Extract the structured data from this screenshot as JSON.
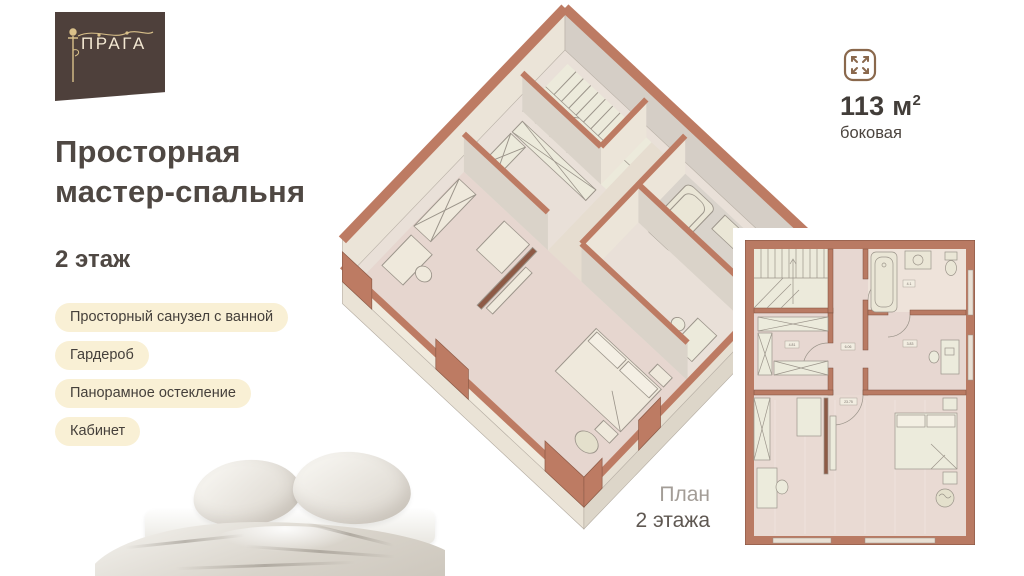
{
  "logo": {
    "brand": "ПРАГА",
    "icon": "lamppost-icon"
  },
  "header": {
    "title_line1": "Просторная",
    "title_line2": "мастер-спальня",
    "floor_label": "2 этаж"
  },
  "features": [
    {
      "label": "Просторный санузел с ванной"
    },
    {
      "label": "Гардероб"
    },
    {
      "label": "Панорамное остекление"
    },
    {
      "label": "Кабинет"
    }
  ],
  "area_badge": {
    "icon": "expand-arrows-icon",
    "area_value": "113 м",
    "area_sup": "2",
    "layout_type": "боковая"
  },
  "plan_caption": {
    "line1": "План",
    "line2": "2 этажа"
  },
  "floor_plan": {
    "labels": {
      "wardrobe": "4.81",
      "hallway": "6.06",
      "office": "3.83",
      "bedroom": "23.75",
      "bathroom": "4.1"
    },
    "colors": {
      "wall": "#bd7b63",
      "wall_dark": "#8d5a46",
      "floor_pink": "#e7d7d1",
      "floor_cream": "#eceadb",
      "furniture": "#edebdc"
    }
  }
}
